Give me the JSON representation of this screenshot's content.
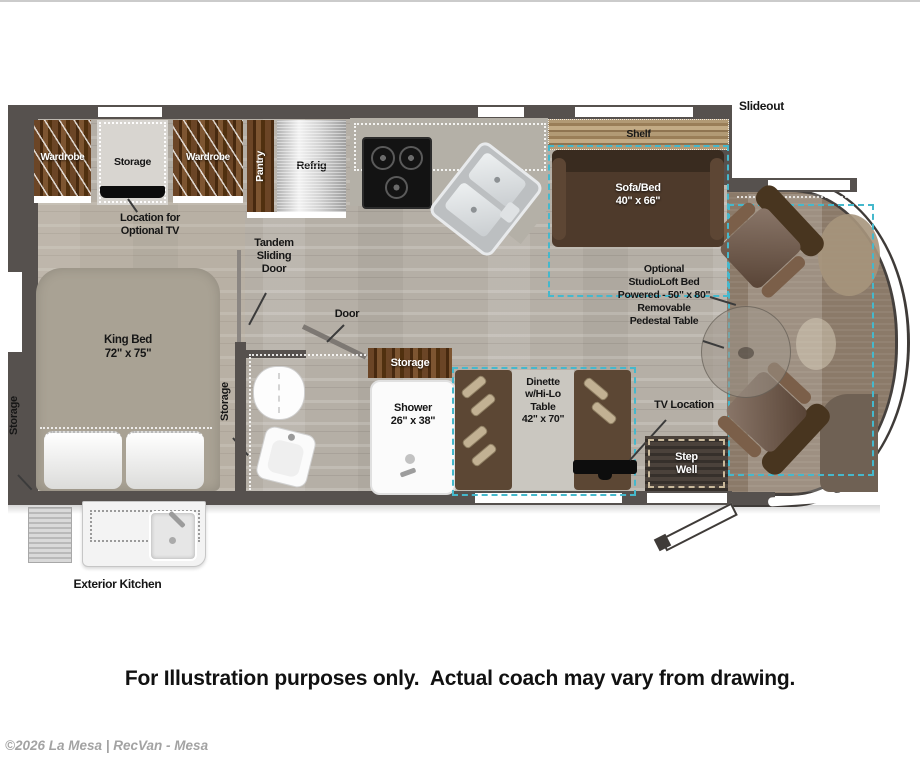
{
  "floorplan": {
    "slideout_label": "Slideout",
    "bedroom": {
      "wardrobe_left": "Wardrobe",
      "storage_cabinet": "Storage",
      "wardrobe_right": "Wardrobe",
      "tv_note": "Location for\nOptional TV",
      "king_bed": "King Bed\n72\" x 75\"",
      "storage_rear": "Storage",
      "storage_side": "Storage",
      "tandem_door": "Tandem\nSliding\nDoor"
    },
    "kitchen": {
      "pantry": "Pantry",
      "refrigerator": "Refrig"
    },
    "bath": {
      "door": "Door",
      "storage_overhead": "Storage",
      "shower": "Shower\n26\" x 38\""
    },
    "living": {
      "shelf": "Shelf",
      "sofa_bed": "Sofa/Bed\n40\" x 66\"",
      "dinette": "Dinette\nw/Hi-Lo\nTable\n42\" x 70\"",
      "studioloft_note": "Optional\nStudioLoft Bed\nPowered - 50\" x 80\"\nRemovable\nPedestal Table",
      "tv_location": "TV Location",
      "step_well": "Step\nWell"
    },
    "exterior_kitchen_label": "Exterior Kitchen"
  },
  "footer": {
    "disclaimer": "For Illustration purposes only.  Actual coach may vary from drawing.",
    "watermark": "©2026 La Mesa | RecVan - Mesa"
  },
  "colors": {
    "accent_dashed": "#45b8cc",
    "wall": "#56514e",
    "floor_wood": "#b5afa6",
    "cab_floor": "#8b7a69",
    "sofa_brown": "#4e3a2b",
    "bench_brown": "#5c4734",
    "bed_olive": "#a9a294"
  }
}
